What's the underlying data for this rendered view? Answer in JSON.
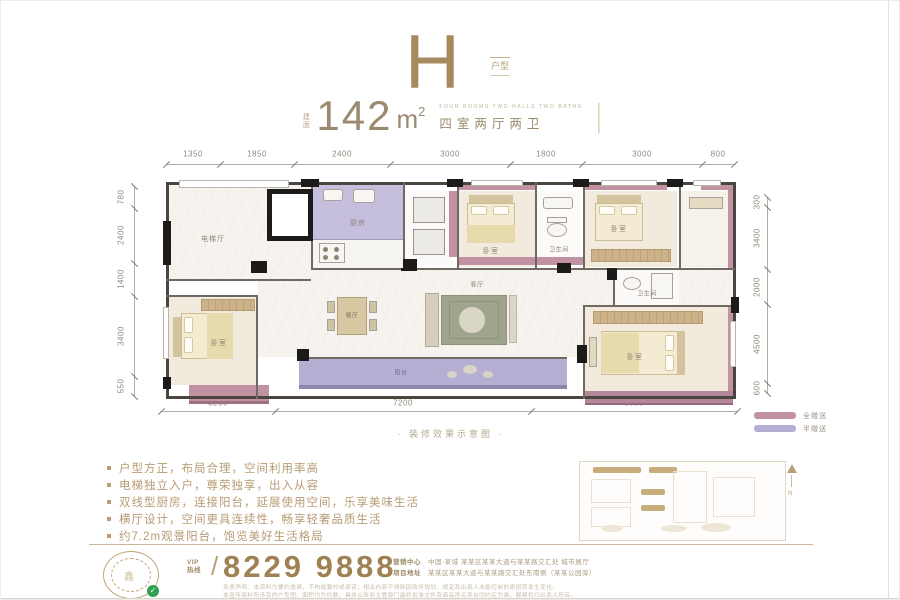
{
  "header": {
    "plan_letter": "H",
    "plan_tag": "户型",
    "area_label": "建面",
    "area_value": "142",
    "area_unit": "m",
    "area_exp": "2",
    "subtitle_en": "FOUR ROOMS TWO HALLS TWO BATHS",
    "subtitle_cn": "四室两厅两卫"
  },
  "dims": {
    "top": [
      "1350",
      "1850",
      "2400",
      "3000",
      "1800",
      "3000",
      "800"
    ],
    "left": [
      "780",
      "2400",
      "1400",
      "3400",
      "550"
    ],
    "right": [
      "300",
      "3400",
      "2000",
      "4500",
      "600"
    ],
    "bottom": [
      "3200",
      "7200",
      "5800"
    ]
  },
  "plan": {
    "rooms": [
      "电梯厅",
      "厨房",
      "卧室",
      "卫生间",
      "卧室",
      "卫生间",
      "餐厅",
      "客厅",
      "阳台",
      "卧室",
      "卧室"
    ],
    "caption": "· 装修效果示意图 ·"
  },
  "legend": {
    "items": [
      {
        "label": "全赠送",
        "color": "#c291a2"
      },
      {
        "label": "半赠送",
        "color": "#b6afd4"
      }
    ]
  },
  "features": {
    "items": [
      "户型方正，布局合理，空间利用率高",
      "电梯独立入户，尊荣独享，出入从容",
      "双线型厨房，连接阳台，延展使用空间，乐享美味生活",
      "横厅设计，空间更具连续性，畅享轻奢品质生活",
      "约7.2m观景阳台，饱览美好生活格局"
    ]
  },
  "keyplan": {
    "north": "N"
  },
  "footer": {
    "vip": "VIP",
    "hotline": "热线",
    "slash": "/",
    "phone": "8229 9888",
    "addr_label1": "营销中心",
    "addr1": "中国·某城 某某区某某大道与某某路交汇处 城市展厅",
    "addr_label2": "项目地址",
    "addr2": "某某区某某大道与某某路交汇处东南侧（某某公园旁）",
    "disclaimer1": "免责声明：本资料为要约邀请，不构成要约或承诺；相关内容不排除因政府规划、规定及出卖人未能控制的原因而发生变化。",
    "disclaimer2": "本宣传资料所涉及的户型图、面积均为约数，具体以政府主管部门最终批准文件及商品房买卖合同约定为准。解释权归出卖人所有。",
    "seal_char": "鑫",
    "check": "✓"
  },
  "colors": {
    "accent_gold": "#a6895c",
    "gift_full": "#c291a2",
    "gift_half": "#b6afd4",
    "phone_color": "#9f8254"
  }
}
